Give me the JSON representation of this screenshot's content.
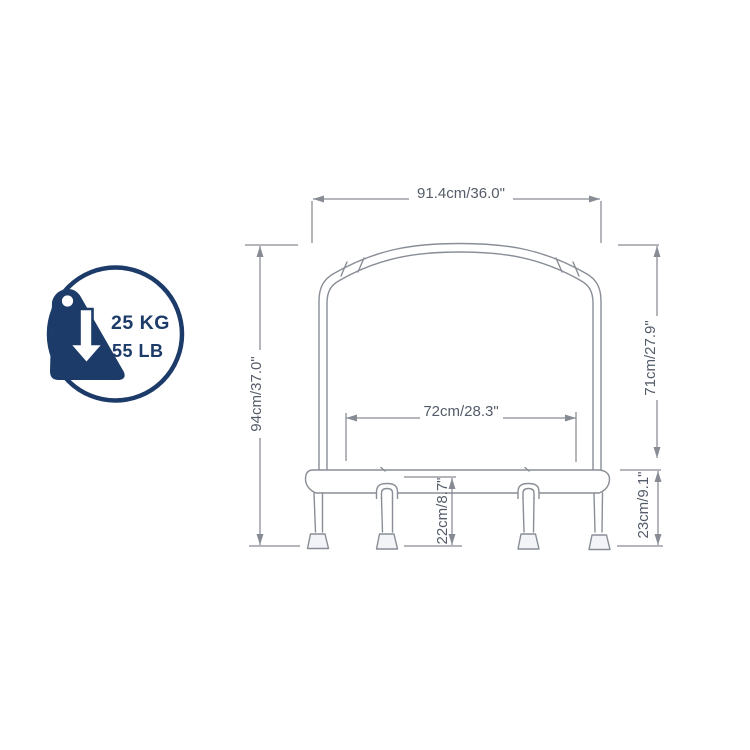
{
  "figure": {
    "type": "technical-dimension-diagram",
    "background": "#ffffff"
  },
  "weight_badge": {
    "capacity_kg": "25 KG",
    "capacity_lb": "55 LB",
    "icon": "falling-weight-arrow-icon",
    "color": "#1c3b69"
  },
  "dimensions": {
    "top_width": "91.4cm/36.0\"",
    "overall_height": "94cm/37.0\"",
    "arch_height": "71cm/27.9\"",
    "inner_width": "72cm/28.3\"",
    "leg_height": "22cm/8.7\"",
    "base_height": "23cm/9.1\""
  },
  "style": {
    "line_color": "#898e96",
    "dim_color": "#868b94",
    "text_color": "#545c69"
  }
}
